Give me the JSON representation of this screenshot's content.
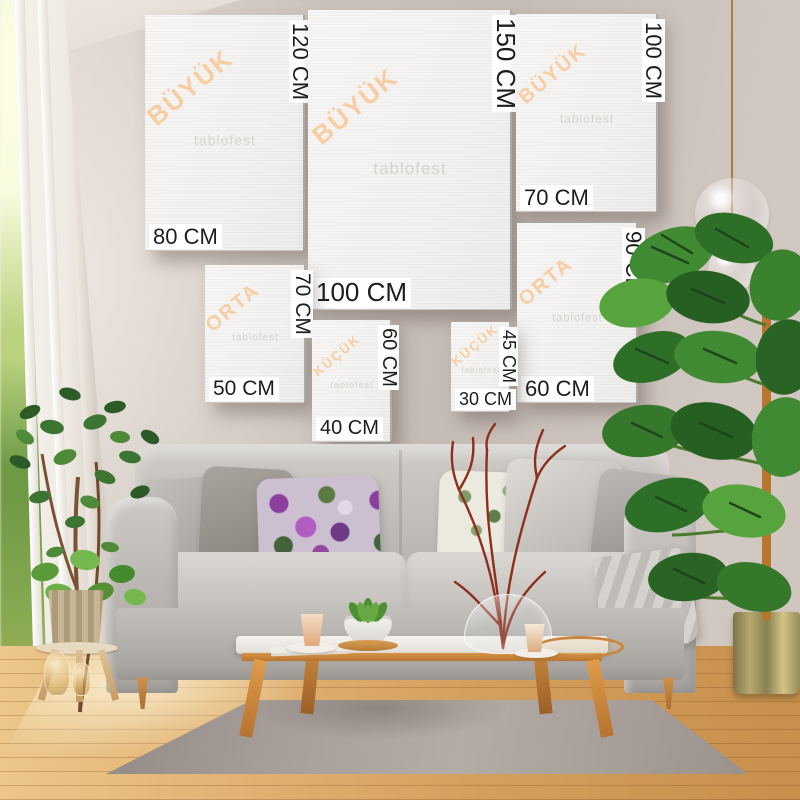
{
  "watermark": "tablofest",
  "size_chart": {
    "frames": [
      {
        "category": "BÜYÜK",
        "width": "80 CM",
        "height": "120 CM"
      },
      {
        "category": "BÜYÜK",
        "width": "100 CM",
        "height": "150 CM"
      },
      {
        "category": "BÜYÜK",
        "width": "70 CM",
        "height": "100 CM"
      },
      {
        "category": "ORTA",
        "width": "50 CM",
        "height": "70 CM"
      },
      {
        "category": "ORTA",
        "width": "60 CM",
        "height": "90 CM"
      },
      {
        "category": "KÜÇÜK",
        "width": "40 CM",
        "height": "60 CM"
      },
      {
        "category": "KÜÇÜK",
        "width": "30 CM",
        "height": "45 CM"
      }
    ],
    "dimension_text_color": "#1d1d1b",
    "category_text_color": "#f8cda2",
    "canvas_color": "#f4f3f1"
  },
  "scene_colors": {
    "wall": "#cbc1bb",
    "floor_wood": "#dca862",
    "rug": "#a89f9a",
    "sofa": "#bdbab6",
    "table_wood": "#cf8f42",
    "plant_green": "#3f8a33",
    "branch_red": "#8d2f1d",
    "pendant_cord_gold": "#a8803c"
  }
}
